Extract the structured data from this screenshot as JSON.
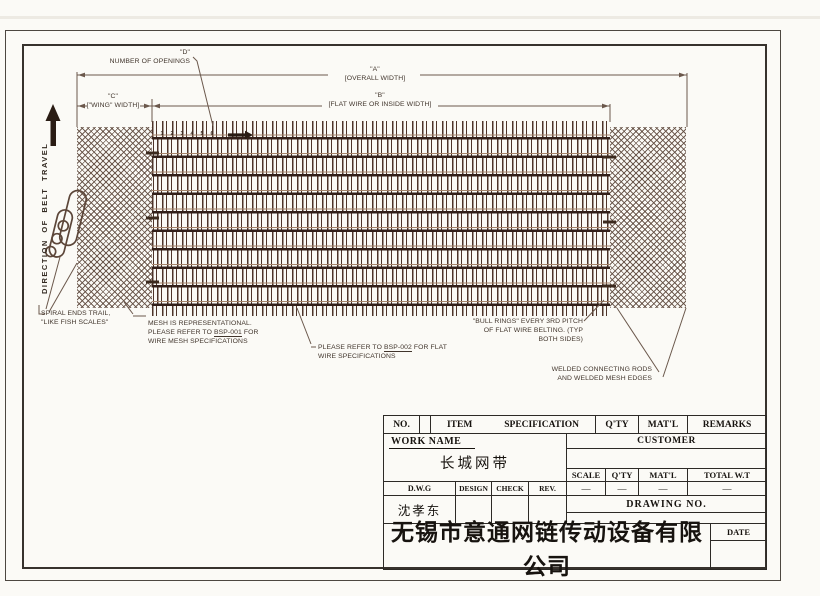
{
  "drawing": {
    "dims": {
      "a": {
        "id": "\"A\"",
        "label": "[OVERALL WIDTH]"
      },
      "b": {
        "id": "\"B\"",
        "label": "[FLAT WIRE OR INSIDE WIDTH]"
      },
      "c": {
        "id": "\"C\"",
        "label": "[\"WING\" WIDTH]"
      },
      "d": {
        "id": "\"D\"",
        "label": "NUMBER OF OPENINGS"
      }
    },
    "direction_label": "DIRECTION OF BELT TRAVEL",
    "opening_numbers": [
      "1",
      "2",
      "3",
      "4",
      "5",
      "6"
    ],
    "notes": {
      "spiral": {
        "line1": "SPIRAL ENDS TRAIL,",
        "line2": "\"LIKE FISH SCALES\""
      },
      "mesh": {
        "line1": "MESH IS REPRESENTATIONAL.",
        "line2_pre": "PLEASE REFER TO ",
        "line2_ref": "BSP-001",
        "line2_post": " FOR",
        "line3": "WIRE MESH SPECIFICATIONS"
      },
      "flat_wire": {
        "line1_pre": "PLEASE REFER TO ",
        "line1_ref": "BSP-002",
        "line1_post": " FOR FLAT",
        "line2": "WIRE SPECIFICATIONS"
      },
      "bull_rings": {
        "line1": "\"BULL RINGS\" EVERY 3RD PITCH",
        "line2": "OF FLAT WIRE BELTING. (TYP",
        "line3": "BOTH SIDES)"
      },
      "welded": {
        "line1": "WELDED CONNECTING RODS",
        "line2": "AND WELDED MESH EDGES"
      }
    },
    "colors": {
      "mesh_wire": "#4e342a",
      "mesh_rod": "#33201a",
      "crosshatch": "#5f4a3e",
      "drafting_line": "#6b584c",
      "ink": "#41352c"
    }
  },
  "title_block": {
    "header": {
      "no": "NO.",
      "item": "ITEM",
      "specification": "SPECIFICATION",
      "qty": "Q'TY",
      "matl": "MAT'L",
      "remarks": "REMARKS"
    },
    "work_name": {
      "label": "WORK NAME",
      "value": "长城网带"
    },
    "customer_label": "CUSTOMER",
    "summary": {
      "scale_label": "SCALE",
      "qty_label": "Q'TY",
      "matl_label": "MAT'L",
      "total_label": "TOTAL W.T",
      "scale_value": "—",
      "qty_value": "—",
      "matl_value": "—",
      "total_value": "—"
    },
    "approval": {
      "dwg": "D.W.G",
      "design": "DESIGN",
      "check": "CHECK",
      "rev": "REV.",
      "dwg_value": "沈孝东"
    },
    "drawing_no_label": "DRAWING NO.",
    "date_label": "DATE",
    "company": "无锡市意通网链传动设备有限公司"
  }
}
